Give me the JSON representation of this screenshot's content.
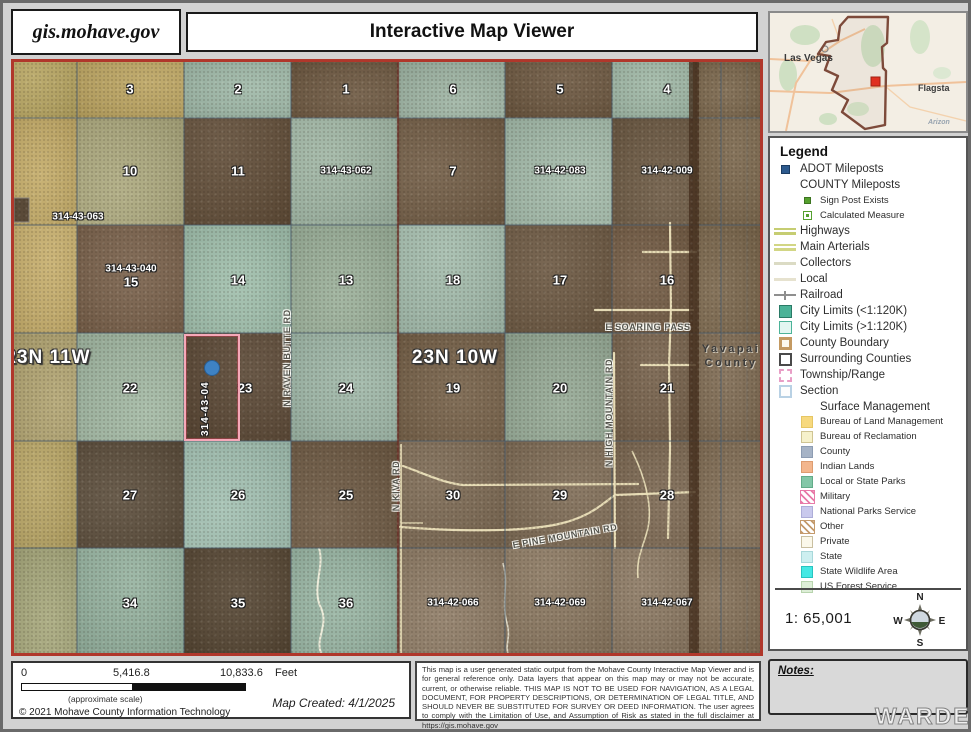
{
  "header": {
    "site": "gis.mohave.gov",
    "title": "Interactive Map Viewer"
  },
  "map": {
    "township_labels": [
      {
        "t": "23N 11W",
        "x": 34,
        "y": 296
      },
      {
        "t": "23N 10W",
        "x": 441,
        "y": 296
      }
    ],
    "county_labels": [
      {
        "t": "Yavapai",
        "x": 717,
        "y": 287
      },
      {
        "t": "County",
        "x": 717,
        "y": 301
      }
    ],
    "section_labels": [
      {
        "t": "3",
        "x": 116,
        "y": 27
      },
      {
        "t": "2",
        "x": 224,
        "y": 27
      },
      {
        "t": "1",
        "x": 332,
        "y": 27
      },
      {
        "t": "6",
        "x": 439,
        "y": 27
      },
      {
        "t": "5",
        "x": 546,
        "y": 27
      },
      {
        "t": "4",
        "x": 653,
        "y": 27
      },
      {
        "t": "10",
        "x": 116,
        "y": 109
      },
      {
        "t": "11",
        "x": 224,
        "y": 109
      },
      {
        "t": "7",
        "x": 439,
        "y": 109
      },
      {
        "t": "15",
        "x": 117,
        "y": 220
      },
      {
        "t": "14",
        "x": 224,
        "y": 218
      },
      {
        "t": "13",
        "x": 332,
        "y": 218
      },
      {
        "t": "18",
        "x": 439,
        "y": 218
      },
      {
        "t": "17",
        "x": 546,
        "y": 218
      },
      {
        "t": "16",
        "x": 653,
        "y": 218
      },
      {
        "t": "22",
        "x": 116,
        "y": 326
      },
      {
        "t": "23",
        "x": 231,
        "y": 326
      },
      {
        "t": "24",
        "x": 332,
        "y": 326
      },
      {
        "t": "19",
        "x": 439,
        "y": 326
      },
      {
        "t": "20",
        "x": 546,
        "y": 326
      },
      {
        "t": "21",
        "x": 653,
        "y": 326
      },
      {
        "t": "27",
        "x": 116,
        "y": 433
      },
      {
        "t": "26",
        "x": 224,
        "y": 433
      },
      {
        "t": "25",
        "x": 332,
        "y": 433
      },
      {
        "t": "30",
        "x": 439,
        "y": 433
      },
      {
        "t": "29",
        "x": 546,
        "y": 433
      },
      {
        "t": "28",
        "x": 653,
        "y": 433
      },
      {
        "t": "34",
        "x": 116,
        "y": 541
      },
      {
        "t": "35",
        "x": 224,
        "y": 541
      },
      {
        "t": "36",
        "x": 332,
        "y": 541
      }
    ],
    "parcel_labels": [
      {
        "t": "314-43-062",
        "x": 332,
        "y": 109
      },
      {
        "t": "314-42-083",
        "x": 546,
        "y": 109
      },
      {
        "t": "314-42-009",
        "x": 653,
        "y": 109
      },
      {
        "t": "314-43-063",
        "x": 64,
        "y": 155
      },
      {
        "t": "314-43-040",
        "x": 117,
        "y": 207
      },
      {
        "t": "314-42-066",
        "x": 439,
        "y": 541
      },
      {
        "t": "314-42-069",
        "x": 546,
        "y": 541
      },
      {
        "t": "314-42-067",
        "x": 653,
        "y": 541
      }
    ],
    "road_labels": [
      {
        "t": "E SOARING PASS",
        "x": 634,
        "y": 265,
        "k": "roadh"
      },
      {
        "t": "E PINE MOUNTAIN RD",
        "x": 551,
        "y": 474,
        "k": "pine"
      },
      {
        "t": "N RAVEN BUTTE RD",
        "x": 273,
        "y": 296,
        "k": "roadv"
      },
      {
        "t": "N HIGH MOUNTAIN RD",
        "x": 595,
        "y": 351,
        "k": "roadv"
      },
      {
        "t": "N KIVA RD",
        "x": 382,
        "y": 424,
        "k": "roadv"
      }
    ],
    "selected_parcel": {
      "label": "314-43-04"
    }
  },
  "inset": {
    "labels": [
      {
        "t": "Las Vegas",
        "x": 14,
        "y": 40,
        "s": 10
      },
      {
        "t": "Flagsta",
        "x": 148,
        "y": 70,
        "s": 9
      },
      {
        "t": "Arizon",
        "x": 158,
        "y": 112,
        "s": 7
      }
    ]
  },
  "legend": {
    "title": "Legend",
    "items": [
      {
        "label": "ADOT Mileposts",
        "type": "square",
        "fill": "#2d5a8e",
        "border": "#1c3c62",
        "size": 9
      },
      {
        "label": "COUNTY Mileposts",
        "type": "none"
      },
      {
        "label": "Sign Post Exists",
        "type": "square",
        "fill": "#55a02e",
        "border": "#3c7420",
        "size": 7,
        "sub": true
      },
      {
        "label": "Calculated Measure",
        "type": "dotsquare",
        "fill": "#ffffff",
        "border": "#55a02e",
        "size": 9,
        "sub": true
      },
      {
        "label": "Highways",
        "type": "dline",
        "fill": "#c6cd72"
      },
      {
        "label": "Main Arterials",
        "type": "dline",
        "fill": "#d2d685"
      },
      {
        "label": "Collectors",
        "type": "line",
        "fill": "#dbdbc4"
      },
      {
        "label": "Local",
        "type": "line",
        "fill": "#e6e2cf"
      },
      {
        "label": "Railroad",
        "type": "rail",
        "fill": "#8f8f8f"
      },
      {
        "label": "City Limits (<1:120K)",
        "type": "square",
        "fill": "#4cb398",
        "border": "#2a7a66",
        "size": 13
      },
      {
        "label": "City Limits (>1:120K)",
        "type": "square",
        "fill": "#e2f6f1",
        "border": "#4cb398",
        "size": 13
      },
      {
        "label": "County Boundary",
        "type": "square",
        "fill": "#fdf9ee",
        "border": "#c49a62",
        "size": 13,
        "bw": 3
      },
      {
        "label": "Surrounding Counties",
        "type": "square",
        "fill": "#ffffff",
        "border": "#4a4a4a",
        "size": 13,
        "bw": 2
      },
      {
        "label": "Township/Range",
        "type": "square",
        "fill": "#ffffff",
        "border": "#e89ec6",
        "size": 13,
        "bw": 2,
        "dashed": true
      },
      {
        "label": "Section",
        "type": "square",
        "fill": "#fdfdfd",
        "border": "#b9d1e4",
        "size": 13,
        "bw": 2
      },
      {
        "label": "Surface Management",
        "type": "header2",
        "sub": true
      },
      {
        "label": "Bureau of Land Management",
        "type": "square",
        "fill": "#f7d97e",
        "border": "#e6c664",
        "size": 12,
        "sub": true
      },
      {
        "label": "Bureau of Reclamation",
        "type": "square",
        "fill": "#f6f1cb",
        "border": "#cfc493",
        "size": 12,
        "sub": true
      },
      {
        "label": "County",
        "type": "square",
        "fill": "#a6b3c6",
        "border": "#8d9cb2",
        "size": 12,
        "sub": true
      },
      {
        "label": "Indian Lands",
        "type": "square",
        "fill": "#f3b68d",
        "border": "#dd9c70",
        "size": 12,
        "sub": true
      },
      {
        "label": "Local or State Parks",
        "type": "square",
        "fill": "#82c7a7",
        "border": "#62ab88",
        "size": 12,
        "sub": true
      },
      {
        "label": "Military",
        "type": "hatch",
        "fill": "#e87aa8",
        "sub": true
      },
      {
        "label": "National Parks Service",
        "type": "square",
        "fill": "#c9c9ed",
        "border": "#adadd8",
        "size": 12,
        "sub": true
      },
      {
        "label": "Other",
        "type": "hatch",
        "fill": "#c49a6c",
        "sub": true
      },
      {
        "label": "Private",
        "type": "square",
        "fill": "#fbf8ea",
        "border": "#c9bfa0",
        "size": 12,
        "sub": true
      },
      {
        "label": "State",
        "type": "square",
        "fill": "#cdeff0",
        "border": "#a8d8da",
        "size": 12,
        "sub": true
      },
      {
        "label": "State Wildlife Area",
        "type": "square",
        "fill": "#45e8e4",
        "border": "#28c4c0",
        "size": 12,
        "sub": true
      },
      {
        "label": "US Forest Service",
        "type": "square",
        "fill": "#ddeed7",
        "border": "#b8d4ae",
        "size": 12,
        "sub": true
      }
    ]
  },
  "scale": {
    "ratio": "1: 65,001",
    "compass": {
      "n": "N",
      "e": "E",
      "s": "S",
      "w": "W"
    }
  },
  "notes": {
    "title": "Notes:"
  },
  "scalebar": {
    "tick0": "0",
    "tick1": "5,416.8",
    "tick2": "10,833.6",
    "unit": "Feet",
    "approx": "(approximate scale)",
    "created": "Map Created: 4/1/2025",
    "copyright": "© 2021 Mohave County Information Technology"
  },
  "disclaimer": "This map is a user generated static output from the Mohave County Interactive Map Viewer and is for general reference only. Data layers that appear on this map may or may not be accurate, current, or otherwise reliable. THIS MAP IS NOT TO BE USED FOR NAVIGATION, AS A LEGAL DOCUMENT, FOR PROPERTY DESCRIPTIONS, OR DETERMINATION OF LEGAL TITLE, AND SHOULD NEVER BE SUBSTITUTED FOR SURVEY OR DEED INFORMATION. The user agrees to comply with the Limitation of Use, and Assumption of Risk as stated in the full disclaimer at https://gis.mohave.gov",
  "watermark": "WARDEX",
  "colors": {
    "map_border": "#b0372b",
    "selection_outline": "#f5a8b8",
    "milepost_dot": "#3e82c4",
    "county_boundary": "#45301f",
    "township_line": "#6e2a1c"
  }
}
